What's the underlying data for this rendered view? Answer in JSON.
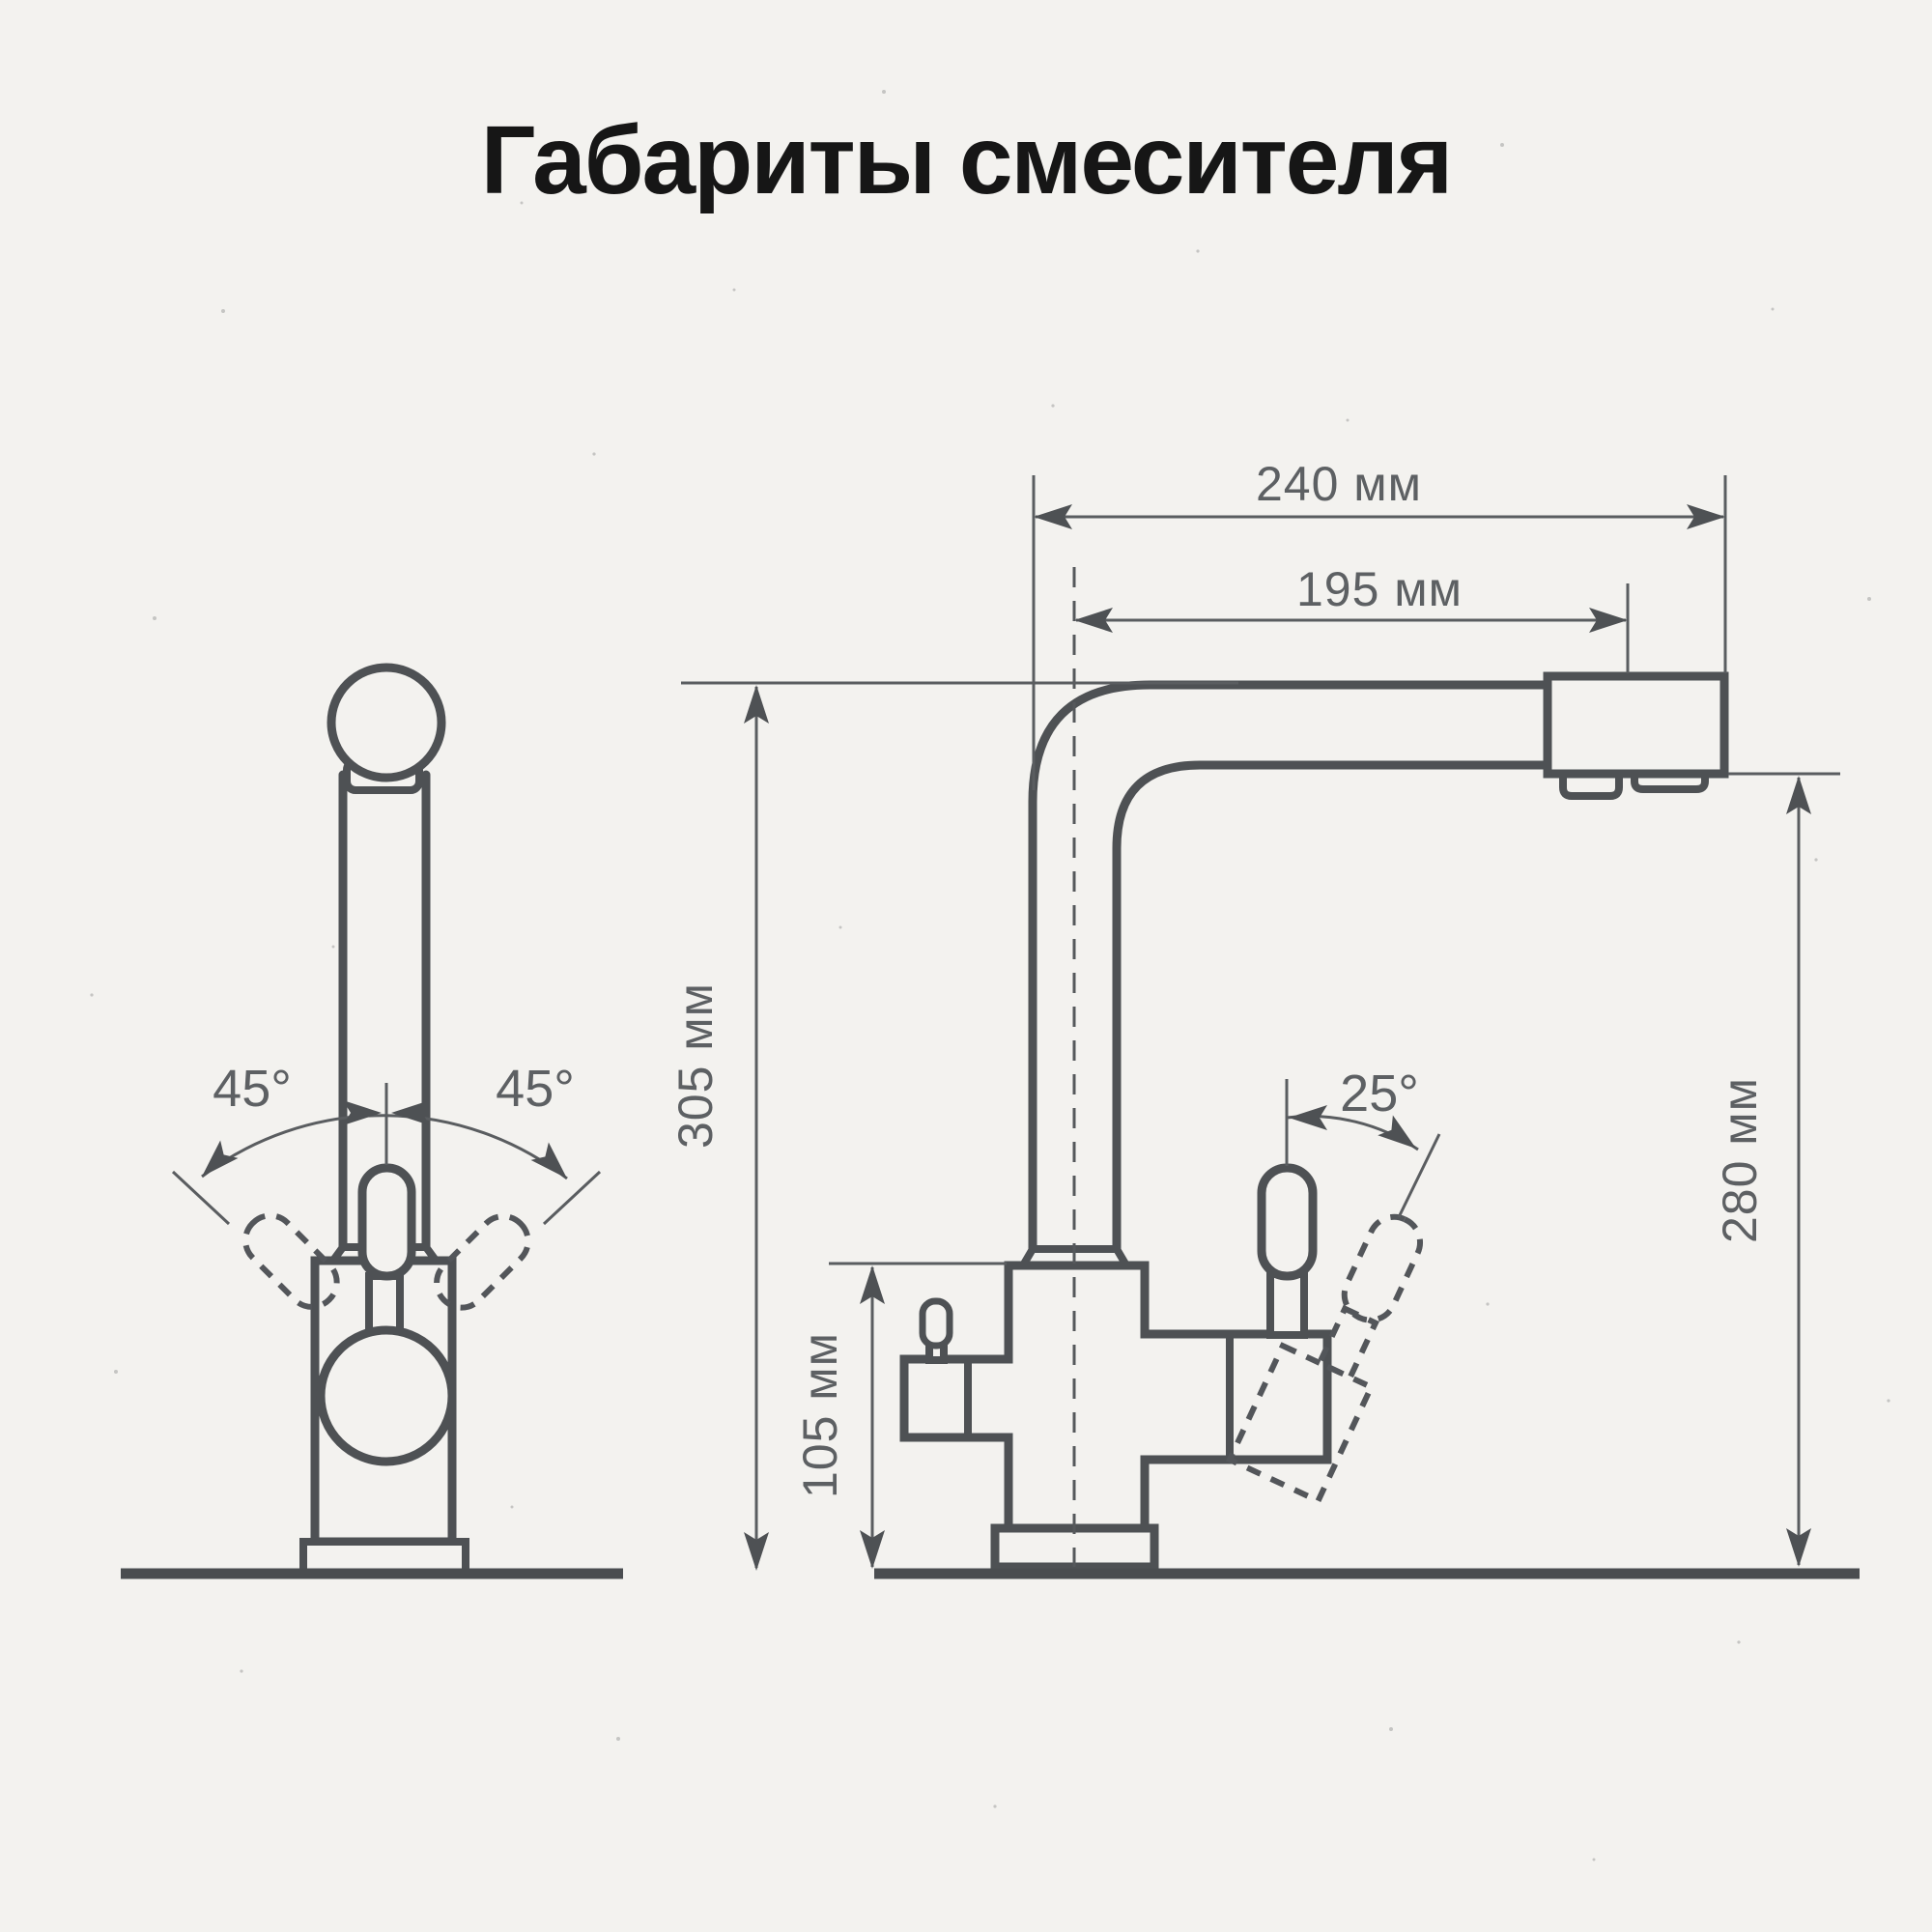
{
  "title": "Габариты смесителя",
  "drawing": {
    "type": "technical-dimension-drawing",
    "subject": "kitchen mixer tap (faucet), two projections",
    "views": [
      {
        "id": "front-view",
        "description": "front projection with handle swivel angles"
      },
      {
        "id": "side-view",
        "description": "side projection with overall dimensions"
      }
    ]
  },
  "dimensions": {
    "total_width": "240 мм",
    "spout_reach": "195 мм",
    "total_height": "305 мм",
    "body_height": "105 мм",
    "spout_height": "280 мм",
    "swivel_left": "45°",
    "swivel_right": "45°",
    "handle_angle": "25°"
  },
  "colors": {
    "background": "#f3f2ef",
    "outline": "#4e5154",
    "dimension_lines": "#5a5d60",
    "dimension_text": "#5d6063",
    "title_text": "#161616"
  }
}
